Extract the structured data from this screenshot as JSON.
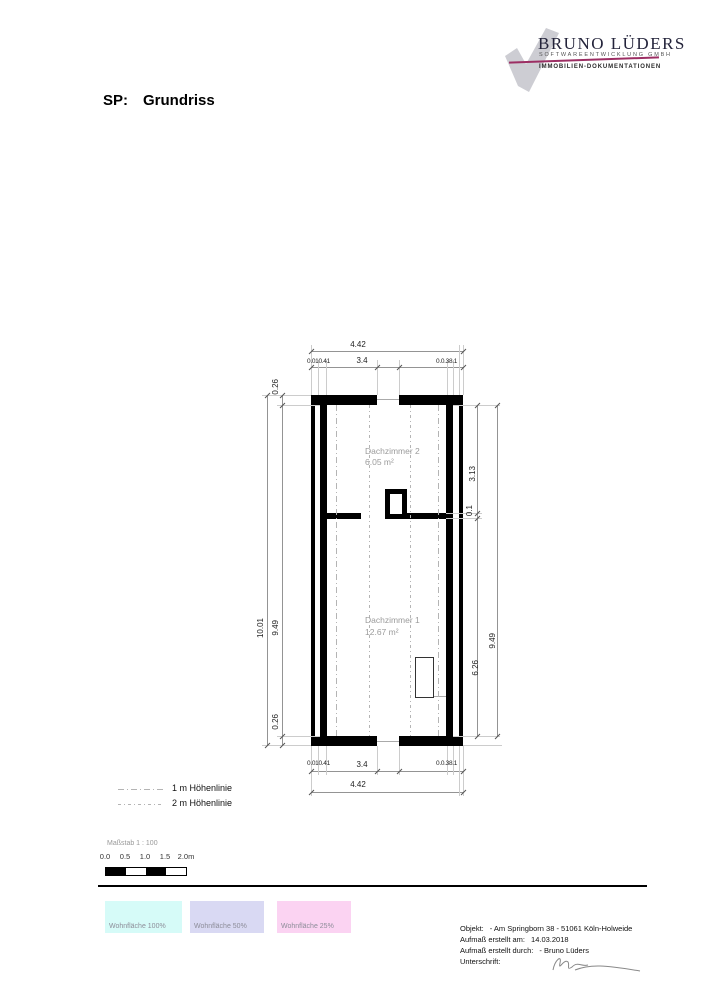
{
  "logo": {
    "company": "BRUNO LÜDERS",
    "subtitle": "SOFTWAREENTWICKLUNG GMBH",
    "tagline": "IMMOBILIEN-DOKUMENTATIONEN",
    "accent_color": "#9c2e63",
    "checkmark_color": "#cdcdd3"
  },
  "title": {
    "prefix": "SP:",
    "text": "Grundriss"
  },
  "plan": {
    "rooms": [
      {
        "name": "Dachzimmer 2",
        "area": "6.05 m²"
      },
      {
        "name": "Dachzimmer 1",
        "area": "12.67 m²"
      }
    ],
    "dims": {
      "top": {
        "total": "4.42",
        "inner": "3.4",
        "left_cluster": "0.010.41",
        "right_cluster": "0.0.38.1"
      },
      "bottom": {
        "total": "4.42",
        "inner": "3.4",
        "left_cluster": "0.010.41",
        "right_cluster": "0.0.38.1"
      },
      "left": {
        "total": "10.01",
        "inner": "9.49",
        "top_offset": "0.26",
        "bottom_offset": "0.26"
      },
      "right": {
        "total": "9.49",
        "upper": "3.13",
        "mid": "0.1",
        "lower": "6.26"
      }
    }
  },
  "legend": {
    "items": [
      {
        "label": "1 m Höhenlinie"
      },
      {
        "label": "2 m Höhenlinie"
      }
    ]
  },
  "scale": {
    "label": "Maßstab 1 : 100",
    "ticks": [
      "0.0",
      "0.5",
      "1.0",
      "1.5",
      "2.0m"
    ]
  },
  "area_legend": [
    {
      "label": "Wohnfläche 100%",
      "color": "#d6fbf8"
    },
    {
      "label": "Wohnfläche 50%",
      "color": "#d9d9f3"
    },
    {
      "label": "Wohnfläche 25%",
      "color": "#fbd3f2"
    }
  ],
  "footer": {
    "rows": [
      {
        "label": "Objekt:",
        "value": "- Am Springborn 38  - 51061 Köln-Holweide"
      },
      {
        "label": "Aufmaß erstellt am:",
        "value": "14.03.2018"
      },
      {
        "label": "Aufmaß erstellt durch:",
        "value": "- Bruno Lüders"
      },
      {
        "label": "Unterschrift:",
        "value": ""
      }
    ]
  }
}
